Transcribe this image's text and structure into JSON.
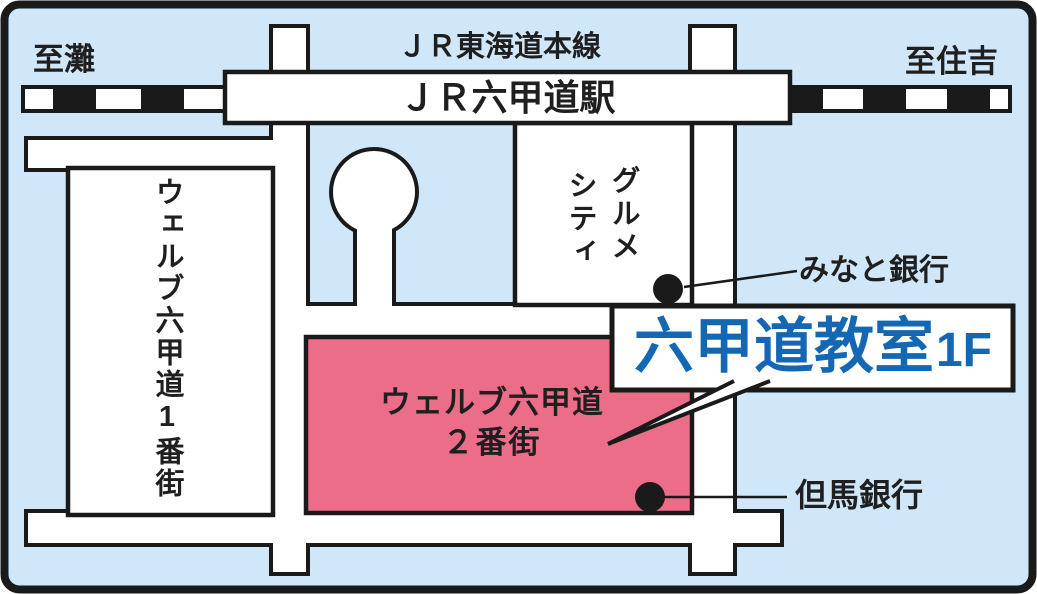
{
  "labels": {
    "direction_left": "至灘",
    "direction_right": "至住吉",
    "rail_line": "ＪＲ東海道本線",
    "station": "ＪＲ六甲道駅",
    "building_welv_1": "ウェルブ六甲道1番街",
    "gourmet_city_right_column": "グルメ",
    "gourmet_city_left_column": "シティ",
    "minato_bank": "みなと銀行",
    "tajima_bank": "但馬銀行",
    "building_welv_2_line1": "ウェルブ六甲道",
    "building_welv_2_line2": "２番街",
    "classroom_name": "六甲道教室",
    "classroom_floor": "1F"
  },
  "colors": {
    "background": "#cfe7f8",
    "highlight_building": "#ec6d87",
    "classroom_text": "#1468b3",
    "ink": "#1f1f1f"
  }
}
